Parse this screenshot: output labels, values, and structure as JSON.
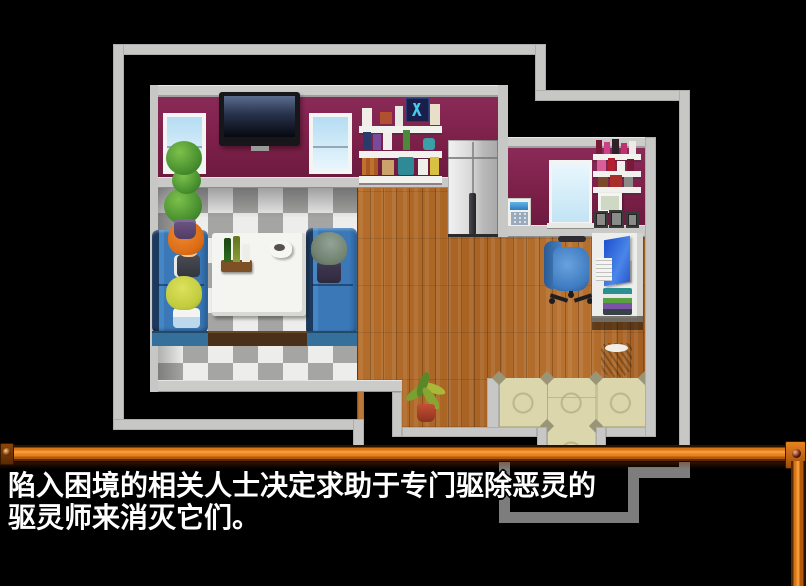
{
  "dialogue": {
    "line1": "陷入困境的相关人士决定求助于专门驱除恶灵的",
    "line2": "驱灵师来消灭它们。"
  },
  "palette": {
    "background": "#000000",
    "frame_orange": "#e8821e",
    "wall_maroon": "#7c2049",
    "outline_light_gray": "#c7c7c5",
    "outline_dim_gray": "#7d7d7d",
    "floor_wood": "#b06a28",
    "checker_light": "#ededeb",
    "checker_gray": "#a5a5a3",
    "entrance_beige": "#dcd6ac",
    "sofa_blue": "#3a78b8",
    "text_color": "#ffffff"
  },
  "scene": {
    "objects": [
      "room-outline",
      "left-wall",
      "right-wall",
      "wall-tv",
      "window",
      "topiary-tree",
      "bookshelf",
      "wall-poster",
      "refrigerator",
      "keypad-panel",
      "grid-window",
      "wall-shelves",
      "picture-frames",
      "booth-bench",
      "dining-table",
      "bottle-tray",
      "coffee-cup",
      "character-orange-hair",
      "character-blonde",
      "character-gray-hair",
      "office-chair",
      "desk",
      "monitor",
      "book-stack",
      "waste-basket",
      "potted-plant",
      "entrance-tiles",
      "dialogue-frame"
    ]
  }
}
